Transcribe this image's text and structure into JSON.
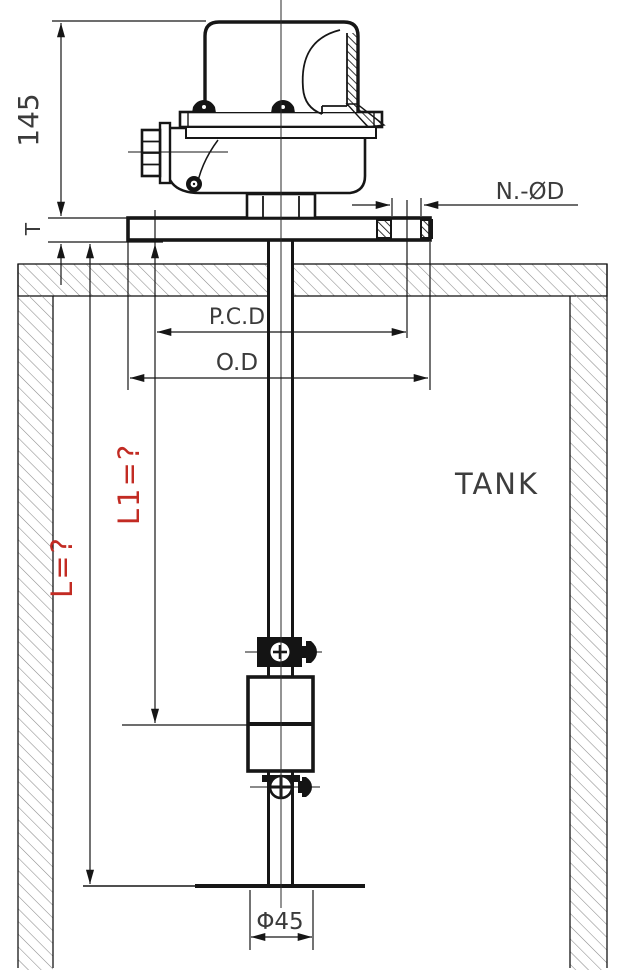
{
  "colors": {
    "line": "#161616",
    "dimension_red": "#c22b23",
    "hatch_gray": "#8a8a8a",
    "hatch_dark": "#141414",
    "text_gray": "#3b3b3b"
  },
  "annotations": {
    "housing_height": "145",
    "flange_thickness": "T",
    "mounting_holes": "N.-ØD",
    "pitch_circle_diameter": "P.C.D",
    "flange_outer_diameter": "O.D",
    "tank_label": "TANK",
    "upper_level_length": "L1=?",
    "total_length": "L=?",
    "float_diameter": "Φ45"
  }
}
